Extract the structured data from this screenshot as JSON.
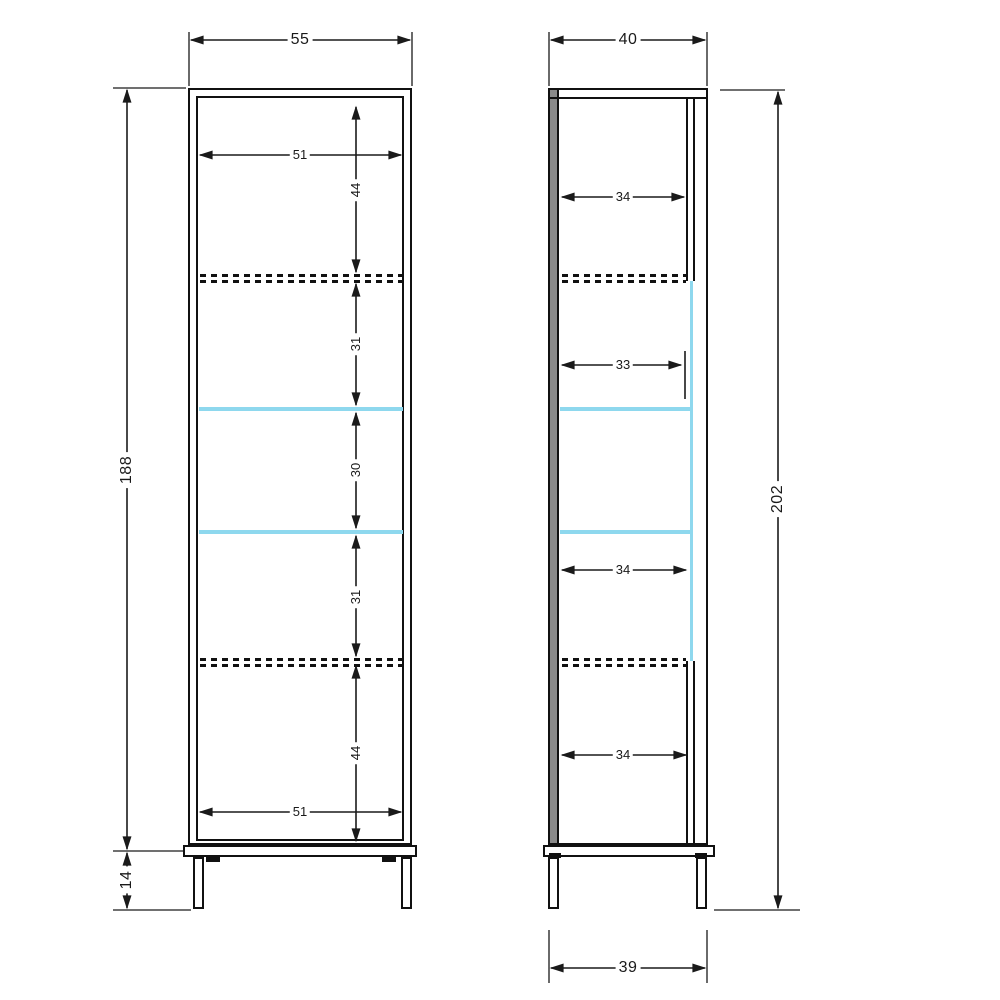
{
  "colors": {
    "outline": "#1a1a1a",
    "glass_shelf": "#8ed8ee",
    "side_panel_gray": "#8a8a8a",
    "background": "#ffffff"
  },
  "front_view": {
    "overall_width": "55",
    "interior_width_top": "51",
    "interior_width_bottom": "51",
    "carcass_height": "188",
    "leg_height": "14",
    "section_heights": {
      "top": "44",
      "upper": "31",
      "middle": "30",
      "lower": "31",
      "bottom": "44"
    }
  },
  "side_view": {
    "overall_depth": "40",
    "shelf_depth_top": "34",
    "shelf_depth_glass": "33",
    "shelf_depth_lower": "34",
    "shelf_depth_bottom": "34",
    "overall_height": "202",
    "base_depth": "39"
  }
}
